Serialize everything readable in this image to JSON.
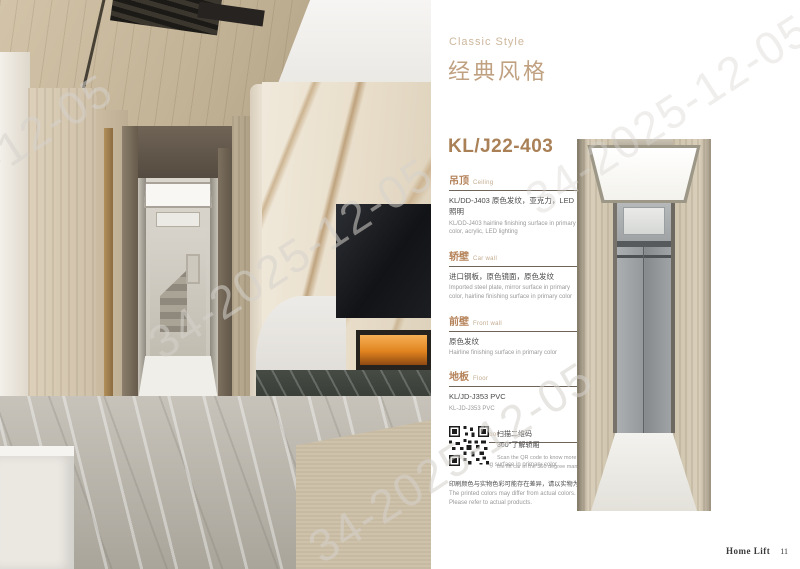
{
  "page": {
    "style_label_en": "Classic Style",
    "style_title_zh": "经典风格",
    "model": "KL/J22-403",
    "watermark_text": "34-2025-12-05",
    "footer": {
      "brand": "Home Lift",
      "page_number": "11"
    }
  },
  "colors": {
    "accent_bronze": "#aa8157",
    "heading_tan": "#c0a181",
    "label_tan": "#cdb79c",
    "section_header": "#b5835a",
    "body_dark": "#4a4a4a",
    "body_gray": "#9a9a9a",
    "divider": "#6e6459"
  },
  "specs": [
    {
      "zh": "吊顶",
      "en": "Ceiling",
      "desc_zh": "KL/DD-J403 原色发纹，亚克力，LED照明",
      "desc_en": "KL/DD-J403 hairline finishing surface in primary color, acrylic, LED lighting"
    },
    {
      "zh": "轿壁",
      "en": "Car wall",
      "desc_zh": "进口钢板，原色镜面，原色发纹",
      "desc_en": "Imported steel plate, mirror surface in primary color, hairline finishing surface in primary color"
    },
    {
      "zh": "前壁",
      "en": "Front wall",
      "desc_zh": "原色发纹",
      "desc_en": "Hairline finishing surface in primary color"
    },
    {
      "zh": "地板",
      "en": "Floor",
      "desc_zh": "KL/JD-J353 PVC",
      "desc_en": "KL-JD-J353 PVC"
    },
    {
      "zh": "轿门",
      "en": "Car door",
      "desc_zh": "原色发纹",
      "desc_en": "Hairline finishing surface in primary color"
    }
  ],
  "qr_block": {
    "line1_zh": "扫描二维码",
    "line2_zh": "360°了解轿厢",
    "line1_en": "Scan the QR code to know more about",
    "line2_en": "the lift car in the 360 degree manner"
  },
  "disclaimer": {
    "zh": "印刷颜色与实物色彩可能存在差异，请以实物为准。",
    "en": "The printed colors may differ from actual colors. Please refer to actual products."
  }
}
